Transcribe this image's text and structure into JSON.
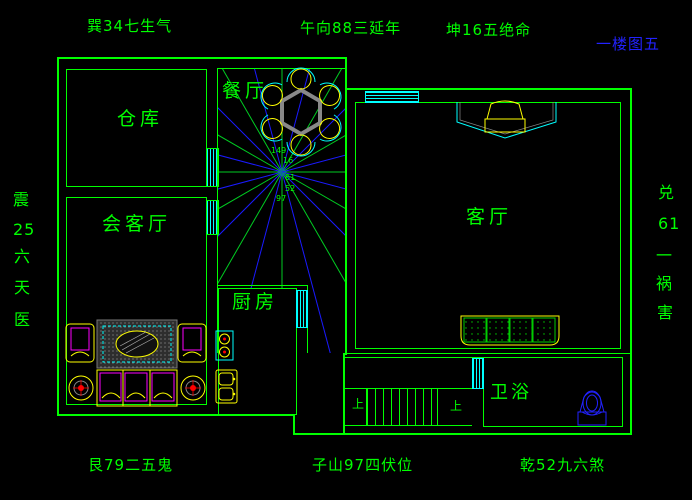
{
  "colors": {
    "wall_green": "#00ff00",
    "window_cyan": "#00ffff",
    "compass_blue": "#1a1aff",
    "furniture_yellow": "#ffff00",
    "detail_magenta": "#ff00ff",
    "title_blue": "#2222ff"
  },
  "top_labels": {
    "left": "巽34七生气",
    "center": "午向88三延年",
    "right": "坤16五绝命"
  },
  "floor_title": "一楼图五",
  "bottom_labels": {
    "left": "艮79二五鬼",
    "center": "子山97四伏位",
    "right": "乾52九六煞"
  },
  "left_column": [
    "震",
    "25",
    "六",
    "天",
    "医"
  ],
  "right_column": [
    "兑",
    "61",
    "一",
    "祸",
    "害"
  ],
  "rooms": {
    "warehouse": "仓库",
    "dining": "餐厅",
    "reception": "会客厅",
    "kitchen": "厨房",
    "living": "客厅",
    "bathroom": "卫浴"
  },
  "stairs": {
    "up_left": "上",
    "up_right": "上"
  },
  "compass_numbers": {
    "n1": "149",
    "n2": "16",
    "n3": "61",
    "n4": "52",
    "n5": "97"
  }
}
